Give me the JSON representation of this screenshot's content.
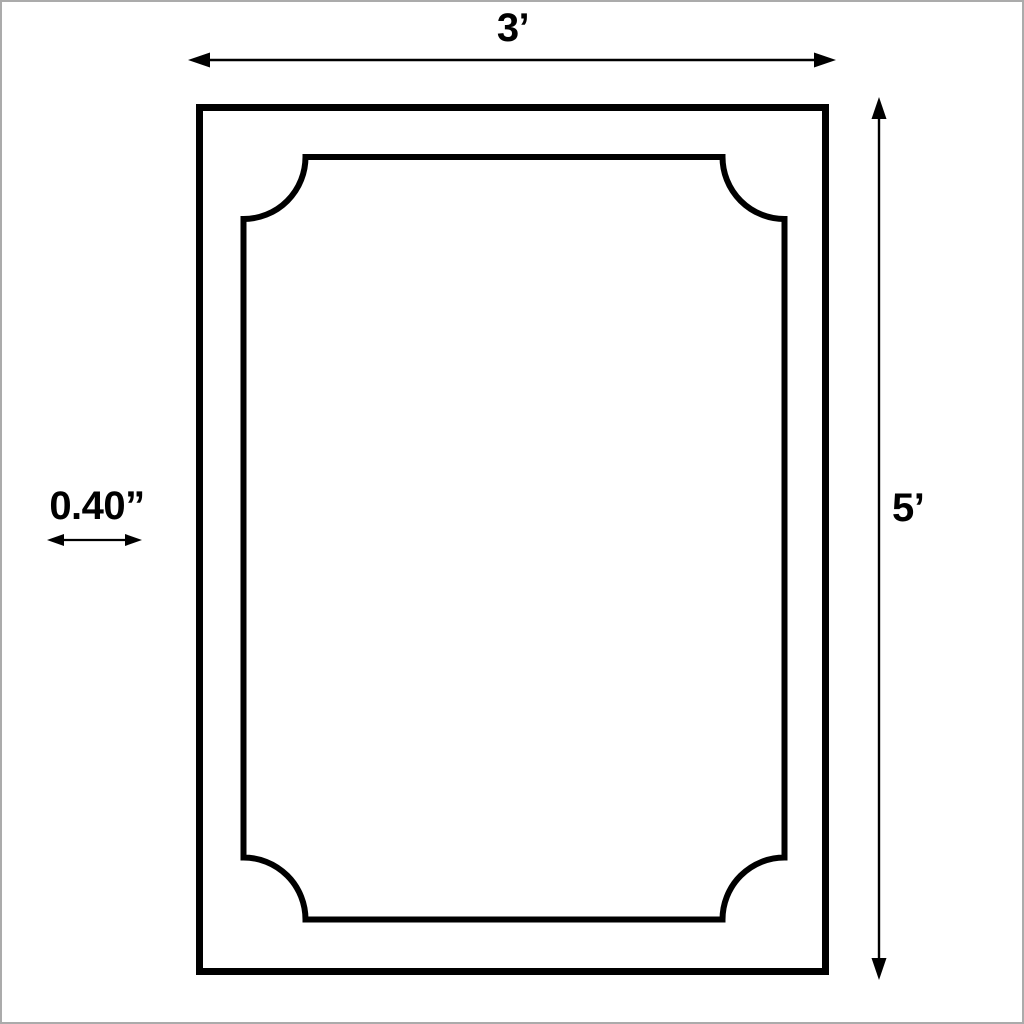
{
  "diagram": {
    "type": "dimension-drawing",
    "subject": "rectangular-frame-with-scalloped-inner-panel",
    "labels": {
      "width": "3’",
      "height": "5’",
      "thickness": "0.40”"
    },
    "colors": {
      "line": "#000000",
      "background": "#ffffff",
      "page_border": "#ababab"
    }
  }
}
